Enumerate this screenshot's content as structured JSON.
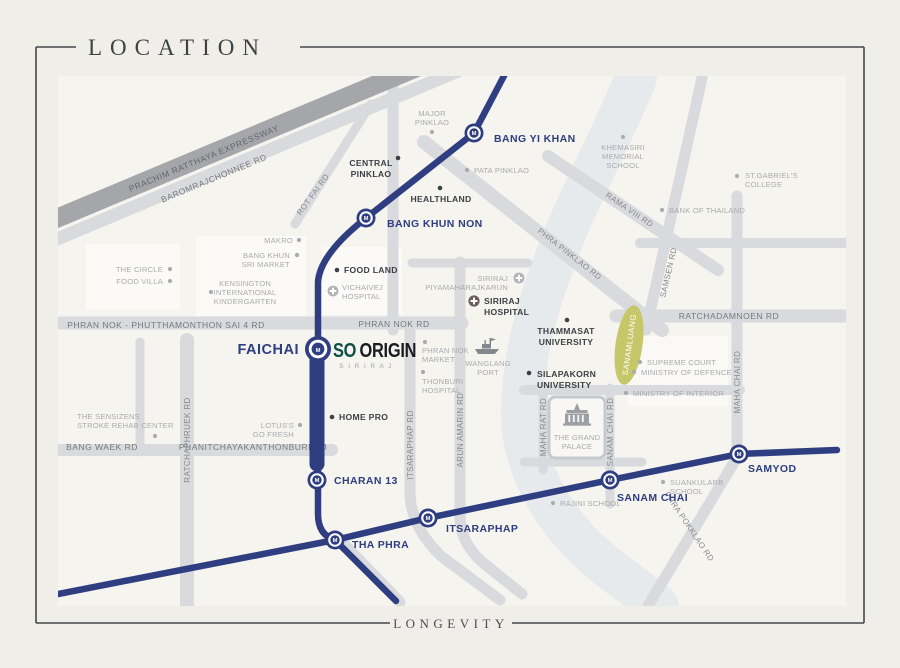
{
  "header": {
    "title": "LOCATION"
  },
  "footer": {
    "label": "LONGEVITY"
  },
  "colors": {
    "mrt_navy": "#2e3e80",
    "sanamluang_green": "#c6c768",
    "logo_teal": "#0f4f43"
  },
  "project": {
    "brand": "SO",
    "brand2": "ORIGIN",
    "subtitle": "S I R I R A J"
  },
  "stations": {
    "m": "M",
    "bang_yi_khan": "BANG YI KHAN",
    "bang_khun_non": "BANG KHUN NON",
    "faichai": "FAICHAI",
    "charan_13": "CHARAN 13",
    "tha_phra": "THA PHRA",
    "itsaraphap": "ITSARAPHAP",
    "sanam_chai": "SANAM CHAI",
    "samyod": "SAMYOD"
  },
  "roads": {
    "expressway": "PRACHIM RATTHAYA EXPRESSWAY",
    "baromrajchonnee": "BAROMRAJCHONNEE RD",
    "rot_fai": "ROT FAI RD",
    "phra_pinklao": "PHRA PINKLAO RD",
    "rama_viii": "RAMA VIII RD",
    "samsen": "SAMSEN RD",
    "ratchadamnoen": "RATCHADAMNOEN RD",
    "maha_chai": "MAHA CHAI RD",
    "phran_nok_sai4": "PHRAN NOK - PHUTTHAMONTHON SAI 4 RD",
    "phran_nok": "PHRAN NOK RD",
    "charan_sanit_wong": "CHARAN SANIT WONG RD",
    "itsaraphap_rd": "ITSARAPHAP RD",
    "arun_amarin": "ARUN AMARIN RD",
    "maha_rat": "MAHA RAT RD",
    "sanam_chai_rd": "SANAM CHAI RD",
    "ratchaphruek": "RATCHAPHRUEK RD",
    "bang_waek": "BANG WAEK RD",
    "phanitchayakanthonburi": "PHANITCHAYAKANTHONBURI RD",
    "phra_pokklao": "PHRA POKKLAO RD"
  },
  "pois": {
    "major_pinklao": [
      "MAJOR",
      "PINKLAO"
    ],
    "central_pinklao": [
      "CENTRAL",
      "PINKLAO"
    ],
    "pata_pinklao": [
      "PATA PINKLAO"
    ],
    "khemasiri": [
      "KHEMASIRI",
      "MEMORIAL",
      "SCHOOL"
    ],
    "st_gabriels": [
      "ST.GABRIEL'S",
      "COLLEGE"
    ],
    "bank_of_thailand": [
      "BANK OF THAILAND"
    ],
    "healthland": [
      "HEALTHLAND"
    ],
    "makro": [
      "MAKRO"
    ],
    "bang_khun_sri": [
      "BANG KHUN",
      "SRI MARKET"
    ],
    "the_circle": [
      "THE CIRCLE"
    ],
    "food_villa": [
      "FOOD VILLA"
    ],
    "kensington": [
      "KENSINGTON",
      "INTERNATIONAL",
      "KINDERGARTEN"
    ],
    "food_land": [
      "FOOD LAND"
    ],
    "vichaivej": [
      "VICHAIVEJ",
      "HOSPITAL"
    ],
    "siriraj_piyamaharajkarun": [
      "SIRIRAJ",
      "PIYAMAHARAJKARUN"
    ],
    "siriraj_hospital": [
      "SIRIRAJ",
      "HOSPITAL"
    ],
    "thammasat": [
      "THAMMASAT",
      "UNIVERSITY"
    ],
    "sanamluang": [
      "SANAMLUANG"
    ],
    "silapakorn": [
      "SILAPAKORN",
      "UNIVERSITY"
    ],
    "wanglang_port": [
      "WANGLANG",
      "PORT"
    ],
    "phran_nok_market": [
      "PHRAN NOK",
      "MARKET"
    ],
    "thonburi_hospital": [
      "THONBURI",
      "HOSPITAL"
    ],
    "supreme_court": [
      "SUPREME COURT"
    ],
    "ministry_defence": [
      "MINISTRY OF DEFENCE"
    ],
    "ministry_interior": [
      "MINISTRY OF INTERIOR"
    ],
    "grand_palace": [
      "THE GRAND",
      "PALACE"
    ],
    "suankularb": [
      "SUANKULARB",
      "SCHOOL"
    ],
    "rajini": [
      "RAJINI SCHOOL"
    ],
    "home_pro": [
      "HOME PRO"
    ],
    "lotus": [
      "LOTUS'S",
      "GO FRESH"
    ],
    "sensizens": [
      "THE SENSIZENS",
      "STROKE REHAB CENTER"
    ]
  }
}
